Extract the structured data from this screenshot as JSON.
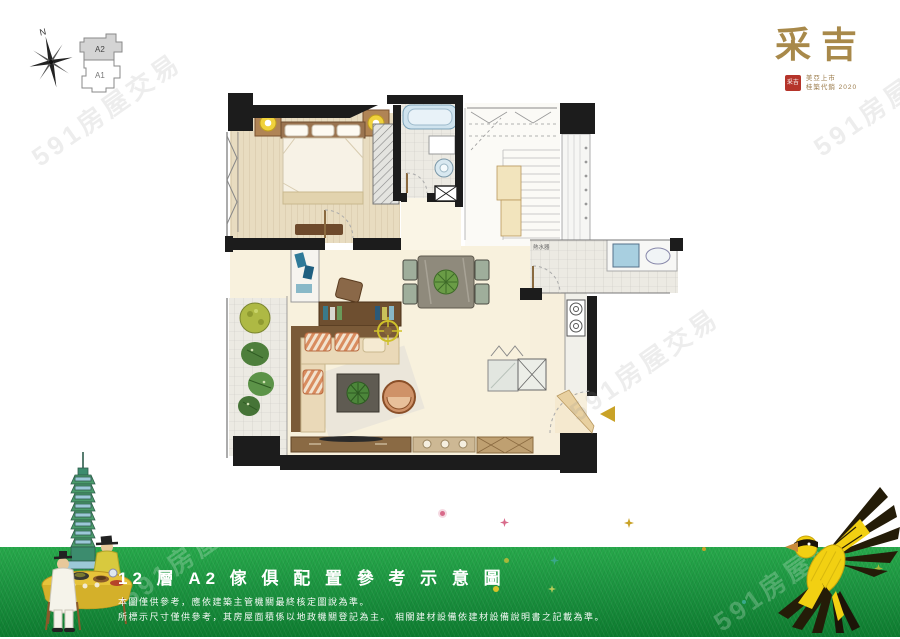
{
  "watermark": {
    "text": "591房屋交易"
  },
  "header": {
    "compass_label": "N",
    "keyplan": {
      "top_unit": "A2",
      "bottom_unit": "A1"
    },
    "logo": {
      "brand": "采吉",
      "seal": "采吉",
      "tagline_line1": "美亞上市",
      "tagline_line2": "桂築代銷 2020"
    }
  },
  "floorplan": {
    "water_heater_label": "熱水器"
  },
  "caption": {
    "title": "12 層 A2 傢 俱 配 置 參 考 示 意 圖",
    "disclaimer_line1": "本圖僅供參考，應依建築主管機關最終核定圖說為準。",
    "disclaimer_line2": "所標示尺寸僅供參考，其房屋面積係以地政機關登記為主。 相關建材設備依建材設備說明書之記載為準。"
  },
  "colors": {
    "grass_green": "#1c9440",
    "logo_gold": "#a8894a",
    "seal_red": "#b5342a",
    "wall_black": "#1c1c1c",
    "entry_arrow_gold": "#c9a227",
    "tub_blue": "#cfe3ee",
    "bird_yellow": "#f2d012"
  }
}
